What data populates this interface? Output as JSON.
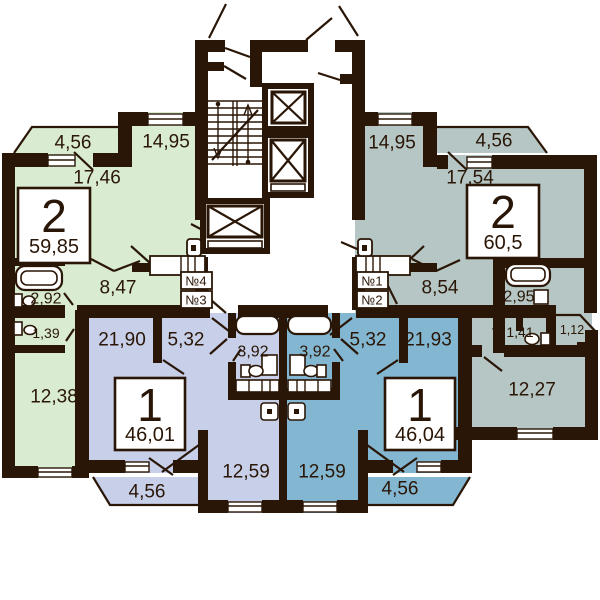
{
  "title": "Typical residential floor plan",
  "colors": {
    "wall_ink": "#2a1606",
    "apartment_left_2room": "#d9ecd2",
    "apartment_right_2room": "#b5c6c4",
    "apartment_left_1room": "#c7cfe9",
    "apartment_right_1room": "#83b6d1",
    "background": "#ffffff"
  },
  "apartments": [
    {
      "id": "left-2room",
      "type_label": "2",
      "total_area": "59,85",
      "rooms": {
        "balcony": "4,56",
        "bedroom": "14,95",
        "living": "17,46",
        "hall": "8,47",
        "bathroom": "2,92",
        "wc": "1,39",
        "kitchen": "12,38"
      }
    },
    {
      "id": "right-2room",
      "type_label": "2",
      "total_area": "60,5",
      "rooms": {
        "balcony": "4,56",
        "bedroom": "14,95",
        "living": "17,54",
        "hall": "8,54",
        "bathroom": "2,95",
        "wc": "1,41",
        "balcony_small": "1,12",
        "kitchen": "12,27"
      }
    },
    {
      "id": "left-1room",
      "type_label": "1",
      "total_area": "46,01",
      "rooms": {
        "living": "21,90",
        "hall": "5,32",
        "bathroom": "3,92",
        "kitchen": "12,59",
        "balcony": "4,56"
      }
    },
    {
      "id": "right-1room",
      "type_label": "1",
      "total_area": "46,04",
      "rooms": {
        "living": "21,93",
        "hall": "5,32",
        "bathroom": "3,92",
        "kitchen": "12,59",
        "balcony": "4,56"
      }
    }
  ],
  "entrance_labels": {
    "n1": "№1",
    "n2": "№2",
    "n3": "№3",
    "n4": "№4"
  }
}
